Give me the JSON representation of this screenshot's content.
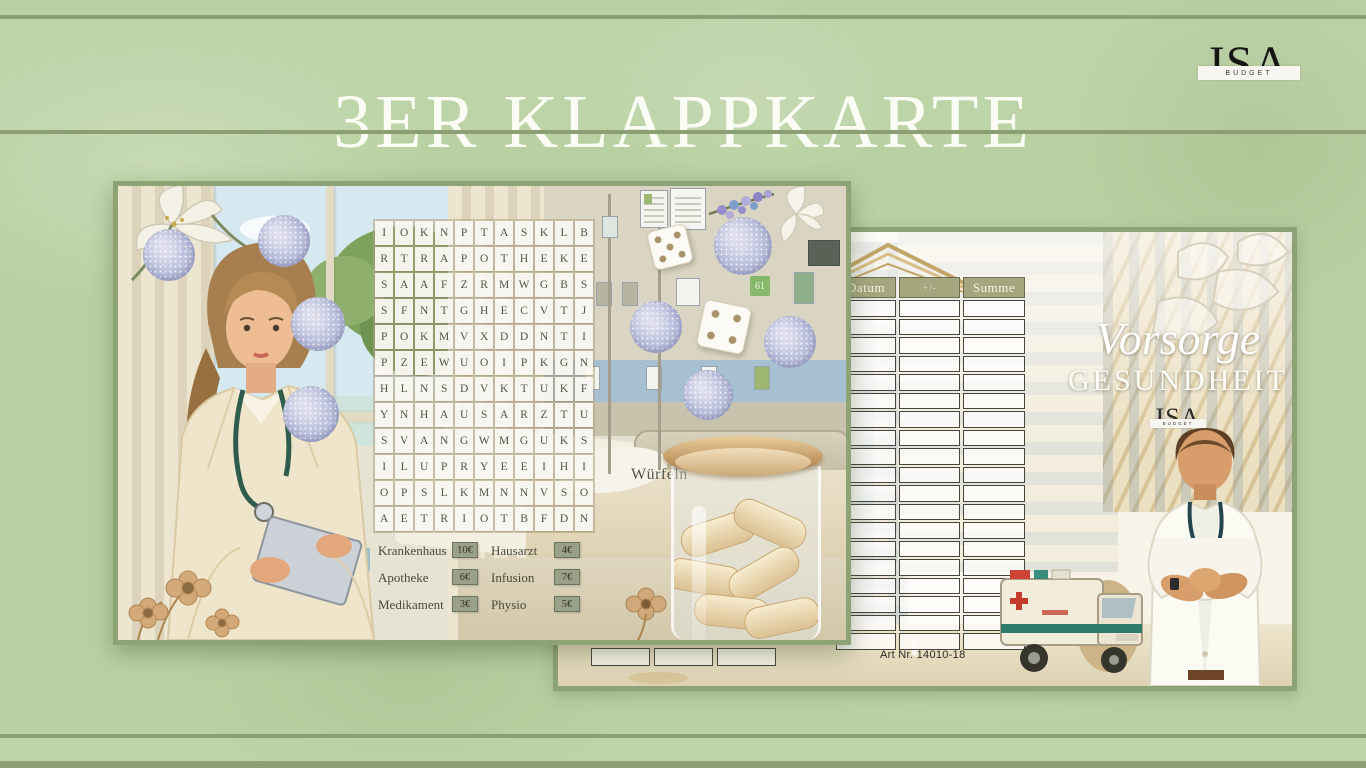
{
  "page": {
    "title": "3ER KLAPPKARTE"
  },
  "header_logo": {
    "name": "ISA",
    "banner": "BUDGET"
  },
  "left_card": {
    "wordsearch_rows": [
      "IOKNPTASKLB",
      "RTRAPOTHEKE",
      "SAAFZRMWGBS",
      "SFNTGHECVTJ",
      "POKMVXDDNTI",
      "PZEWUOIPKGN",
      "HLNSDVKTUKF",
      "YNHAUSARZTU",
      "SVANGWMGUKS",
      "ILUPRYEEIHI",
      "OPSLKMNNVSO",
      "AETRIOTBFDN"
    ],
    "legend": [
      {
        "label": "Krankenhaus",
        "value": "10€"
      },
      {
        "label": "Apotheke",
        "value": "6€"
      },
      {
        "label": "Medikament",
        "value": "3€"
      },
      {
        "label": "Hausarzt",
        "value": "4€"
      },
      {
        "label": "Infusion",
        "value": "7€"
      },
      {
        "label": "Physio",
        "value": "5€"
      }
    ],
    "dice_label": "Würfeln",
    "room_sign": "61"
  },
  "right_card": {
    "table": {
      "headers": [
        "Datum",
        "+/-",
        "Summe"
      ],
      "empty_rows": 19
    },
    "title_script": "Vorsorge",
    "title_caps": "GESUNDHEIT",
    "logo": {
      "name": "ISA",
      "banner": "BUDGET"
    },
    "art_no": "Art Nr. 14010-18"
  },
  "colors": {
    "background": "#b9d1a2",
    "rule_line": "#8b9e74",
    "card_border": "#8da275",
    "table_header": "#a5a67d",
    "glitter": "#b7bbda",
    "legend_box": "#99a189"
  }
}
